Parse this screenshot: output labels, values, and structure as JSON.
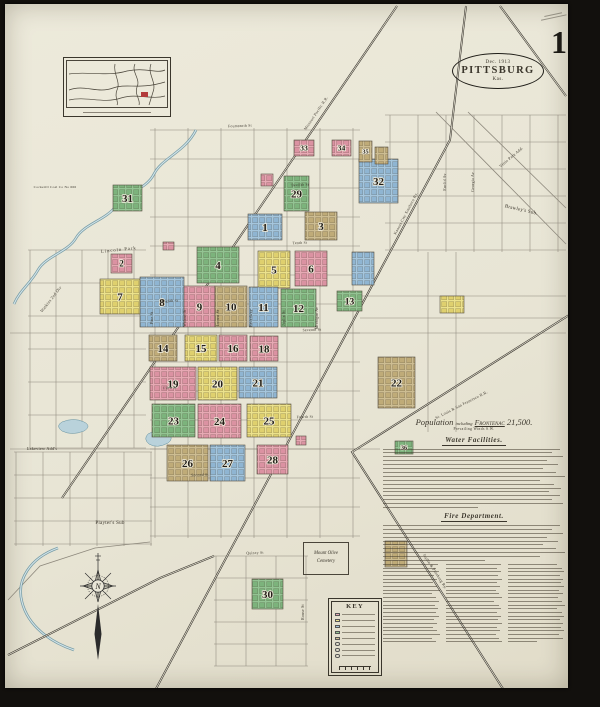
{
  "sheet": {
    "number": "1"
  },
  "title_oval": {
    "date": "Dec. 1913",
    "city": "PITTSBURG",
    "state": "Kas."
  },
  "cemetery": {
    "line1": "Mount Olive",
    "line2": "Cemetery"
  },
  "compass": {
    "letter": "N"
  },
  "notes": {
    "population_prefix": "Population",
    "population_mid": "including",
    "population_name": "Frontenac",
    "population_value": "21,500.",
    "winds": "Prevailing Winds S.W.",
    "water_heading": "Water Facilities.",
    "fire_heading": "Fire Department.",
    "key_title": "KEY"
  },
  "map": {
    "palette": {
      "pink": {
        "base": "#e7a9b4",
        "dark": "#db92a2"
      },
      "yellow": {
        "base": "#ece28c",
        "dark": "#dfd06e"
      },
      "blue": {
        "base": "#a5c6dd",
        "dark": "#8fb5d2"
      },
      "green": {
        "base": "#93c493",
        "dark": "#7cb37c"
      },
      "tan": {
        "base": "#cdbd92",
        "dark": "#bfab78"
      }
    },
    "blocks": [
      {
        "n": "1",
        "c": "blue",
        "x": 248,
        "y": 214,
        "w": 34,
        "h": 26
      },
      {
        "n": "2",
        "c": "pink",
        "x": 111,
        "y": 254,
        "w": 21,
        "h": 19
      },
      {
        "n": "3",
        "c": "tan",
        "x": 305,
        "y": 212,
        "w": 32,
        "h": 28
      },
      {
        "n": "4",
        "c": "green",
        "x": 197,
        "y": 247,
        "w": 42,
        "h": 36
      },
      {
        "n": "5",
        "c": "yellow",
        "x": 258,
        "y": 251,
        "w": 32,
        "h": 37
      },
      {
        "n": "6",
        "c": "pink",
        "x": 295,
        "y": 251,
        "w": 32,
        "h": 35
      },
      {
        "n": "7",
        "c": "yellow",
        "x": 100,
        "y": 279,
        "w": 40,
        "h": 35
      },
      {
        "n": "8",
        "c": "blue",
        "x": 140,
        "y": 277,
        "w": 44,
        "h": 50
      },
      {
        "n": "9",
        "c": "pink",
        "x": 184,
        "y": 286,
        "w": 31,
        "h": 41
      },
      {
        "n": "10",
        "c": "tan",
        "x": 215,
        "y": 286,
        "w": 32,
        "h": 41
      },
      {
        "n": "11",
        "c": "blue",
        "x": 249,
        "y": 287,
        "w": 29,
        "h": 40
      },
      {
        "n": "12",
        "c": "green",
        "x": 281,
        "y": 289,
        "w": 35,
        "h": 38
      },
      {
        "n": "13",
        "c": "green",
        "x": 337,
        "y": 291,
        "w": 25,
        "h": 20
      },
      {
        "n": "14",
        "c": "tan",
        "x": 149,
        "y": 335,
        "w": 28,
        "h": 26
      },
      {
        "n": "15",
        "c": "yellow",
        "x": 185,
        "y": 335,
        "w": 32,
        "h": 26
      },
      {
        "n": "16",
        "c": "pink",
        "x": 219,
        "y": 335,
        "w": 28,
        "h": 26
      },
      {
        "n": "18",
        "c": "pink",
        "x": 250,
        "y": 336,
        "w": 28,
        "h": 25
      },
      {
        "n": "19",
        "c": "pink",
        "x": 150,
        "y": 367,
        "w": 46,
        "h": 33
      },
      {
        "n": "20",
        "c": "yellow",
        "x": 198,
        "y": 367,
        "w": 39,
        "h": 33
      },
      {
        "n": "21",
        "c": "blue",
        "x": 239,
        "y": 367,
        "w": 38,
        "h": 31
      },
      {
        "n": "22",
        "c": "tan",
        "x": 378,
        "y": 357,
        "w": 37,
        "h": 51
      },
      {
        "n": "23",
        "c": "green",
        "x": 152,
        "y": 404,
        "w": 43,
        "h": 33
      },
      {
        "n": "24",
        "c": "pink",
        "x": 198,
        "y": 404,
        "w": 43,
        "h": 34
      },
      {
        "n": "25",
        "c": "yellow",
        "x": 247,
        "y": 404,
        "w": 44,
        "h": 33
      },
      {
        "n": "26",
        "c": "tan",
        "x": 167,
        "y": 445,
        "w": 41,
        "h": 36
      },
      {
        "n": "27",
        "c": "blue",
        "x": 210,
        "y": 445,
        "w": 35,
        "h": 36
      },
      {
        "n": "28",
        "c": "pink",
        "x": 257,
        "y": 445,
        "w": 31,
        "h": 29
      },
      {
        "n": "29",
        "c": "green",
        "x": 284,
        "y": 176,
        "w": 25,
        "h": 35
      },
      {
        "n": "30",
        "c": "green",
        "x": 252,
        "y": 579,
        "w": 31,
        "h": 30
      },
      {
        "n": "31",
        "c": "green",
        "x": 113,
        "y": 185,
        "w": 29,
        "h": 26
      },
      {
        "n": "32",
        "c": "blue",
        "x": 359,
        "y": 159,
        "w": 39,
        "h": 44
      },
      {
        "n": "33",
        "c": "pink",
        "x": 294,
        "y": 140,
        "w": 20,
        "h": 16
      },
      {
        "n": "34",
        "c": "pink",
        "x": 332,
        "y": 140,
        "w": 19,
        "h": 16
      },
      {
        "n": "35",
        "c": "tan",
        "x": 359,
        "y": 141,
        "w": 13,
        "h": 21
      },
      {
        "n": "36",
        "c": "green",
        "x": 395,
        "y": 441,
        "w": 18,
        "h": 13
      },
      {
        "n": "",
        "c": "tan",
        "x": 375,
        "y": 147,
        "w": 13,
        "h": 17
      },
      {
        "n": "",
        "c": "pink",
        "x": 261,
        "y": 174,
        "w": 12,
        "h": 12
      },
      {
        "n": "",
        "c": "blue",
        "x": 352,
        "y": 252,
        "w": 22,
        "h": 33
      },
      {
        "n": "",
        "c": "yellow",
        "x": 440,
        "y": 296,
        "w": 24,
        "h": 17
      },
      {
        "n": "",
        "c": "pink",
        "x": 163,
        "y": 242,
        "w": 11,
        "h": 8
      },
      {
        "n": "",
        "c": "pink",
        "x": 296,
        "y": 436,
        "w": 10,
        "h": 9
      },
      {
        "n": "",
        "c": "tan",
        "x": 385,
        "y": 541,
        "w": 22,
        "h": 26
      }
    ],
    "grids": [
      {
        "o": "v",
        "f": 155,
        "t": 354,
        "s": 33,
        "a": 128,
        "b": 538
      },
      {
        "o": "h",
        "f": 130,
        "t": 537,
        "s": 29,
        "a": 150,
        "b": 360
      },
      {
        "o": "v",
        "f": 390,
        "t": 562,
        "s": 28,
        "a": 115,
        "b": 252
      },
      {
        "o": "h",
        "f": 115,
        "t": 251,
        "s": 27,
        "a": 385,
        "b": 566
      },
      {
        "o": "v",
        "f": 16,
        "t": 152,
        "s": 27,
        "a": 452,
        "b": 546
      },
      {
        "o": "h",
        "f": 452,
        "t": 546,
        "s": 23,
        "a": 14,
        "b": 152
      },
      {
        "o": "v",
        "f": 216,
        "t": 307,
        "s": 30,
        "a": 556,
        "b": 666
      },
      {
        "o": "h",
        "f": 556,
        "t": 666,
        "s": 22,
        "a": 214,
        "b": 308
      },
      {
        "o": "v",
        "f": 30,
        "t": 141,
        "s": 26,
        "a": 250,
        "b": 448
      },
      {
        "o": "h",
        "f": 250,
        "t": 448,
        "s": 33,
        "a": 28,
        "b": 146
      },
      {
        "o": "h",
        "f": 296,
        "t": 319,
        "s": 22,
        "a": 360,
        "b": 566
      },
      {
        "o": "h",
        "f": 333,
        "t": 333,
        "s": 50,
        "a": 10,
        "b": 566
      },
      {
        "o": "h",
        "f": 449,
        "t": 449,
        "s": 50,
        "a": 10,
        "b": 380
      },
      {
        "o": "v",
        "f": 428,
        "t": 457,
        "s": 28,
        "a": 252,
        "b": 432
      }
    ],
    "roads": [
      {
        "pts": [
          [
            468,
            112
          ],
          [
            566,
            208
          ]
        ]
      },
      {
        "pts": [
          [
            436,
            112
          ],
          [
            566,
            244
          ]
        ]
      },
      {
        "pts": [
          [
            8,
            600
          ],
          [
            40,
            566
          ],
          [
            95,
            548
          ],
          [
            150,
            542
          ]
        ]
      }
    ],
    "railroads": [
      {
        "pts": [
          [
            397,
            6
          ],
          [
            62,
            498
          ]
        ]
      },
      {
        "pts": [
          [
            466,
            6
          ],
          [
            450,
            140
          ],
          [
            150,
            700
          ]
        ]
      },
      {
        "pts": [
          [
            585,
            305
          ],
          [
            352,
            452
          ],
          [
            505,
            692
          ]
        ]
      },
      {
        "pts": [
          [
            500,
            6
          ],
          [
            566,
            96
          ]
        ]
      },
      {
        "pts": [
          [
            8,
            655
          ],
          [
            160,
            578
          ],
          [
            214,
            556
          ]
        ]
      }
    ],
    "creeks": [
      {
        "d": "M196,130 C185,152 162,158 154,174 C146,190 126,192 116,206 C106,220 84,224 76,238 C68,252 46,256 38,270 C30,284 20,290 14,304"
      },
      {
        "d": "M58,548 C30,558 16,580 22,602 C28,626 50,642 74,650"
      }
    ],
    "ponds": [
      {
        "d": "M148,434 q10,-6 19,-1 q8,5 1,10 q-11,6 -19,1 q-6,-5 -1,-10 Z"
      },
      {
        "d": "M62,422 q12,-5 22,0 q8,4 0,9 q-12,5 -22,0 q-7,-5 0,-9 Z"
      }
    ],
    "labels": [
      {
        "t": "Lincoln Park",
        "x": 119,
        "y": 251,
        "r": -6,
        "s": 4.6,
        "sp": 1
      },
      {
        "t": "Brawley's Sub.",
        "x": 521,
        "y": 211,
        "r": 13,
        "s": 5
      },
      {
        "t": "Playter's Sub",
        "x": 110,
        "y": 524,
        "r": 0,
        "s": 5
      },
      {
        "t": "Watkins 2nd Div",
        "x": 52,
        "y": 300,
        "r": -52,
        "s": 4.2
      },
      {
        "t": "Lakeview Add's",
        "x": 42,
        "y": 450,
        "r": 0,
        "s": 4.2
      },
      {
        "t": "Cockerill Coal Co No 666",
        "x": 55,
        "y": 188,
        "r": 0,
        "s": 3.5
      },
      {
        "t": "Missouri Pacific R.R.",
        "x": 317,
        "y": 114,
        "r": -56,
        "s": 4
      },
      {
        "t": "Kansas City Southern Ry.",
        "x": 407,
        "y": 214,
        "r": -62,
        "s": 4
      },
      {
        "t": "St. Louis & San Francisco R.R.",
        "x": 462,
        "y": 406,
        "r": -27,
        "s": 4
      },
      {
        "t": "Joplin & Pittsburg Ry.",
        "x": 434,
        "y": 572,
        "r": 57,
        "s": 4
      },
      {
        "t": "Vittie Park Add.",
        "x": 512,
        "y": 158,
        "r": -40,
        "s": 4
      },
      {
        "t": "Pine St",
        "x": 153,
        "y": 318,
        "r": -90,
        "s": 3.8
      },
      {
        "t": "Walnut St",
        "x": 186,
        "y": 318,
        "r": -90,
        "s": 3.8
      },
      {
        "t": "Locust St",
        "x": 219,
        "y": 318,
        "r": -90,
        "s": 3.8
      },
      {
        "t": "Broadway",
        "x": 252,
        "y": 318,
        "r": -90,
        "s": 3.8
      },
      {
        "t": "Joplin St",
        "x": 285,
        "y": 318,
        "r": -90,
        "s": 3.8
      },
      {
        "t": "Michigan Av",
        "x": 318,
        "y": 318,
        "r": -90,
        "s": 3.8
      },
      {
        "t": "Euclid Av",
        "x": 446,
        "y": 182,
        "r": -90,
        "s": 3.8
      },
      {
        "t": "Georgia Av",
        "x": 474,
        "y": 182,
        "r": -90,
        "s": 3.8
      },
      {
        "t": "Rouse St",
        "x": 304,
        "y": 612,
        "r": -90,
        "s": 3.8
      },
      {
        "t": "Fourteenth St",
        "x": 240,
        "y": 127,
        "r": -2,
        "s": 3.8
      },
      {
        "t": "Twelfth St",
        "x": 300,
        "y": 186,
        "r": -2,
        "s": 3.8
      },
      {
        "t": "Tenth St",
        "x": 300,
        "y": 244,
        "r": -2,
        "s": 3.8
      },
      {
        "t": "Eighth St",
        "x": 170,
        "y": 302,
        "r": -2,
        "s": 3.8
      },
      {
        "t": "Seventh St",
        "x": 312,
        "y": 331,
        "r": -2,
        "s": 3.8
      },
      {
        "t": "Fifth St",
        "x": 170,
        "y": 389,
        "r": -2,
        "s": 3.8
      },
      {
        "t": "Fourth St",
        "x": 305,
        "y": 418,
        "r": -2,
        "s": 3.8
      },
      {
        "t": "Second St",
        "x": 200,
        "y": 476,
        "r": -2,
        "s": 3.8
      },
      {
        "t": "Quincy St",
        "x": 255,
        "y": 554,
        "r": -2,
        "s": 3.8
      }
    ]
  }
}
